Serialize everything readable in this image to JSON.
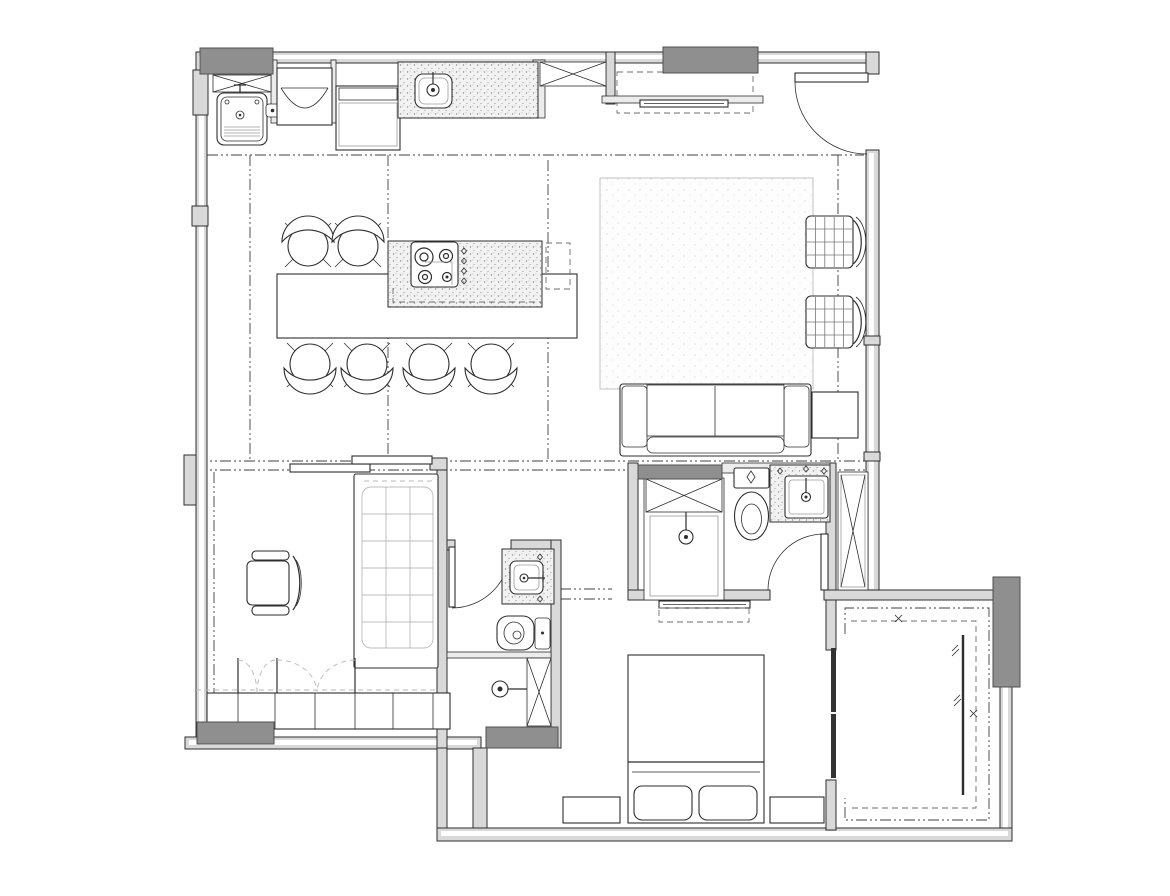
{
  "page": {
    "title": "Apartment Floor Plan",
    "type": "architectural-floor-plan-drawing",
    "visible_text": []
  },
  "canvas": {
    "width": 1170,
    "height": 896
  },
  "palette": {
    "background": "#ffffff",
    "line": "#2e2e2e",
    "line_light": "#9a9a9a",
    "wall_fill": "#d9d9d9",
    "wall_light": "#ececec",
    "column_fill": "#8f8f8f",
    "dashdot": "#3f3f3f",
    "hidden_dash": "#6e6e6e",
    "fold_arc": "#b8b8b8",
    "stipple_dot": "#8f8f8f",
    "rug_dot": "#cdcdcd",
    "mattress_line": "#bcbcbc"
  },
  "symbols": {
    "column-icon": "solid gray rectangle",
    "cabinet-x-icon": "rectangle with diagonal cross",
    "door-swing-icon": "leaf rectangle with quarter-circle arc",
    "bifold-door-icon": "paired dashed quarter arcs",
    "ceiling-line-icon": "dash-dot projection line",
    "counter-icon": "stippled speckle surface",
    "rug-icon": "light stippled rectangle"
  },
  "rooms": [
    {
      "id": "kitchen-laundry",
      "fixtures": [
        "laundry-cabinet-x",
        "laundry-sink",
        "appliance-cabinet",
        "oven",
        "kitchen-sink",
        "kitchen-counter",
        "overhead-cabinet-x"
      ]
    },
    {
      "id": "dining",
      "fixtures": [
        "island-table",
        "island-counter",
        "cooktop"
      ],
      "bar_stool_count": 6
    },
    {
      "id": "living",
      "fixtures": [
        "tv-cabinet-dashed",
        "tv-shelf",
        "tv",
        "entrance-door",
        "rug",
        "sofa",
        "side-table"
      ],
      "armchair_count": 2
    },
    {
      "id": "bedroom-2",
      "fixtures": [
        "sliding-door",
        "single-bed",
        "desk-chair",
        "wardrobe",
        "bifold-doors"
      ]
    },
    {
      "id": "bathroom-2",
      "fixtures": [
        "door",
        "vanity-counter",
        "sink",
        "toilet",
        "floor-drain",
        "shower-head",
        "duct-x"
      ]
    },
    {
      "id": "master-bathroom",
      "fixtures": [
        "shower-enclosure-x",
        "shower-head",
        "toilet-with-cistern",
        "vanity-counter",
        "sink",
        "door",
        "linen-cabinet-x"
      ]
    },
    {
      "id": "master-bedroom",
      "fixtures": [
        "tv-shelf",
        "tv",
        "double-bed",
        "nightstand-left",
        "nightstand-right"
      ],
      "pillow_count": 2
    },
    {
      "id": "walk-in-closet",
      "fixtures": [
        "hanging-rails-u-shape",
        "sliding-panels",
        "mirror-panel"
      ]
    }
  ],
  "column_count": 6,
  "window_walls": [
    "left-full-height",
    "right-living-room"
  ]
}
